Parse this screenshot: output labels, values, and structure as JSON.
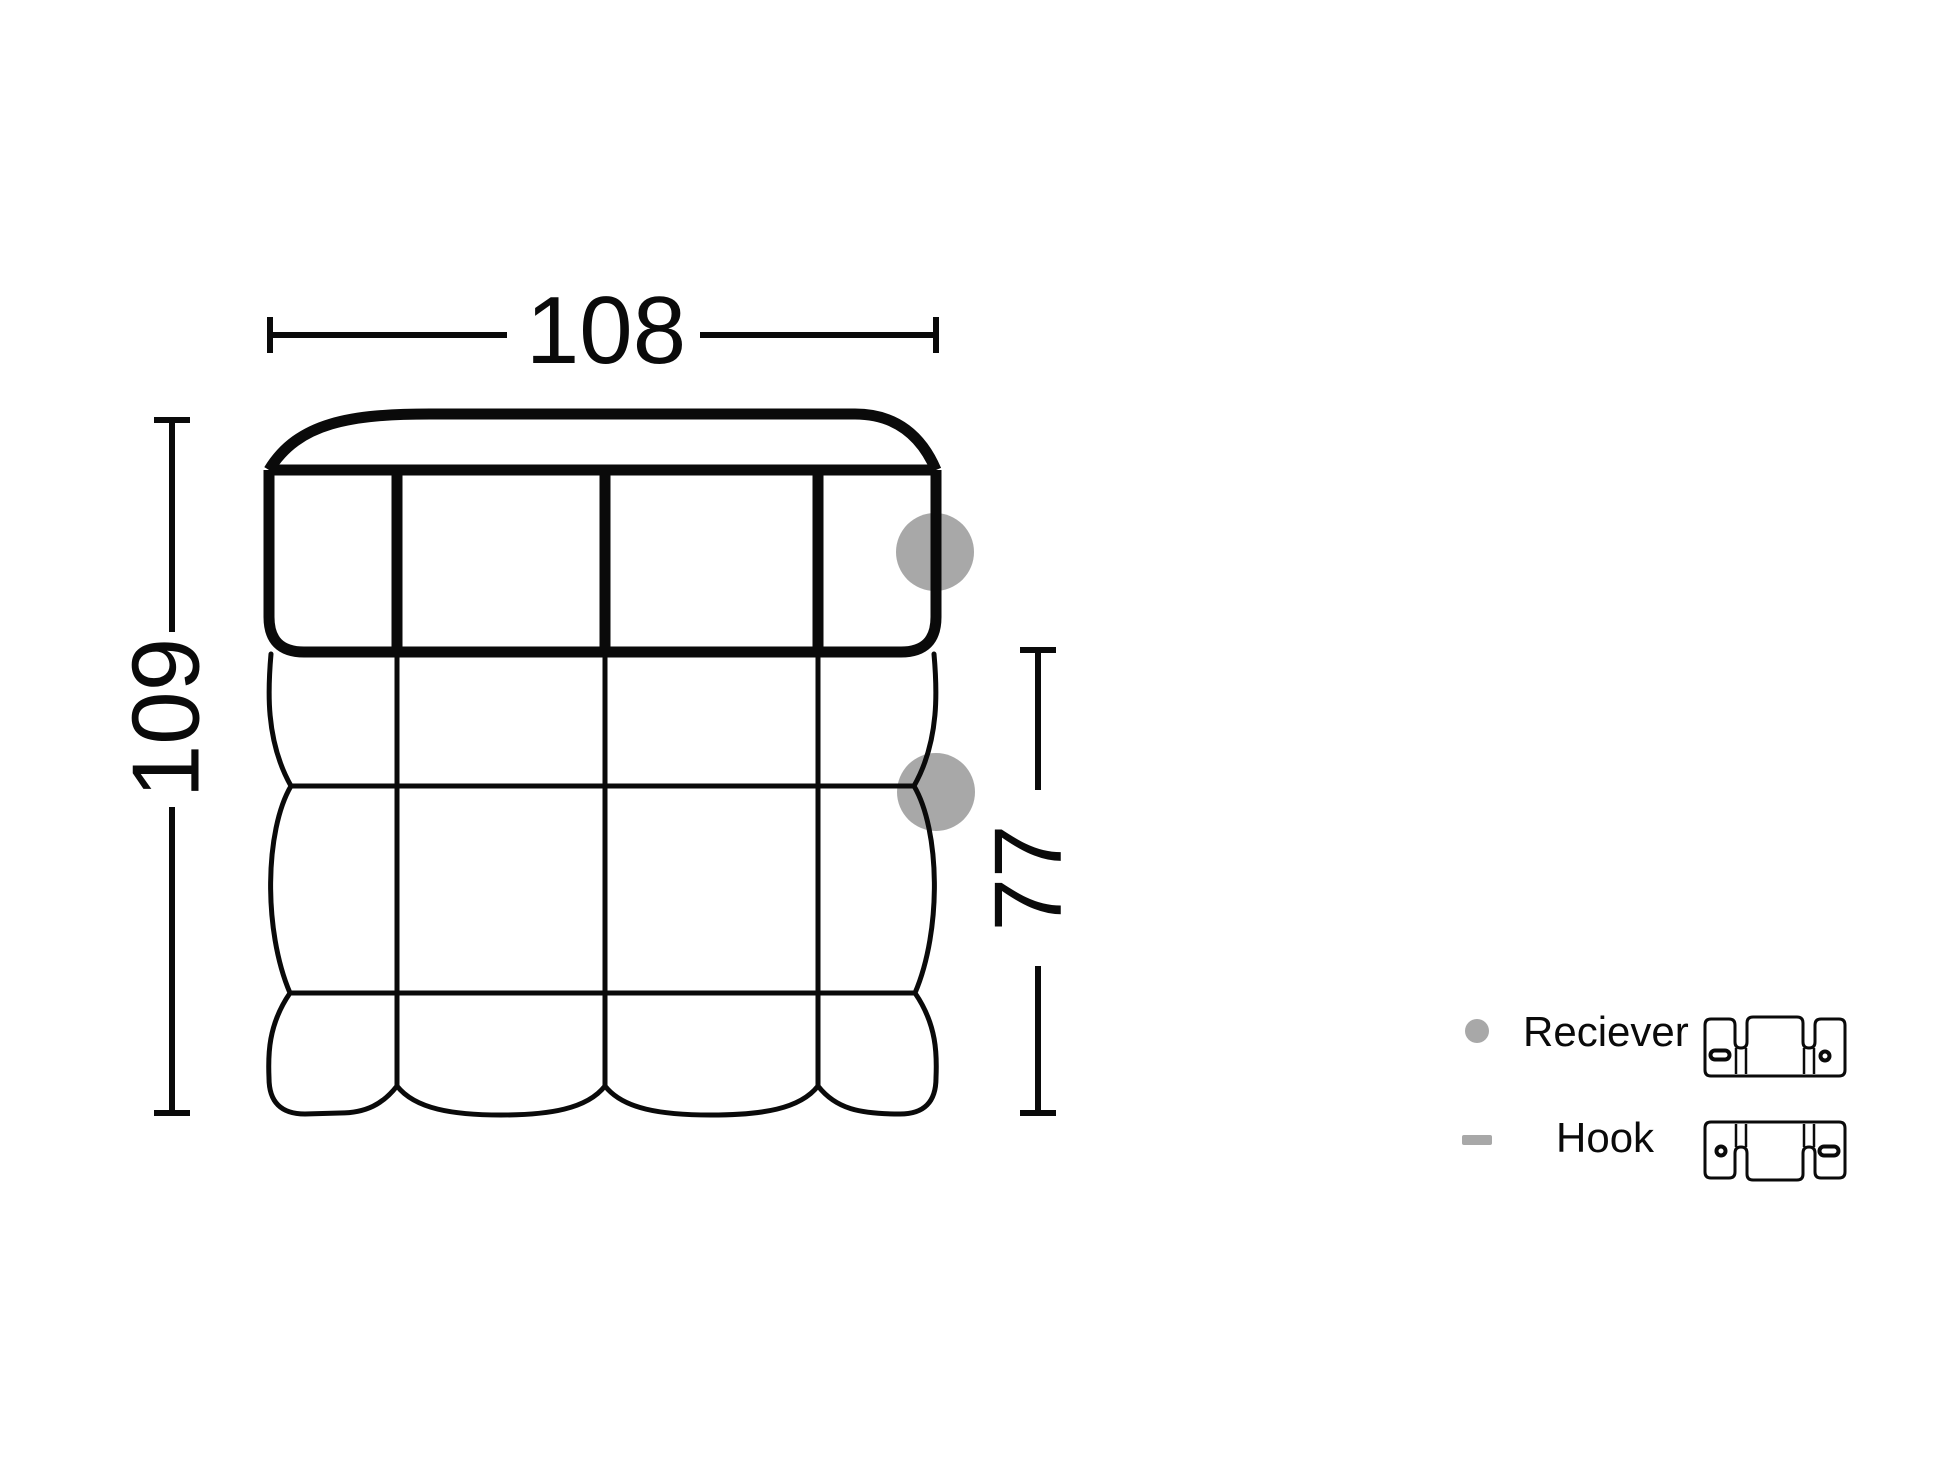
{
  "dimensions": {
    "width": "108",
    "height": "109",
    "depth": "77"
  },
  "legend": {
    "receiver_label": "Reciever",
    "hook_label": "Hook"
  },
  "markers": {
    "receiver_marker_icon": "gray-dot",
    "hook_marker_icon": "gray-dash",
    "receiver_bracket_icon": "receiver-bracket",
    "hook_bracket_icon": "hook-bracket"
  },
  "colors": {
    "line": "#0a0a0a",
    "marker_gray": "#a8a8a8",
    "background": "#ffffff"
  }
}
